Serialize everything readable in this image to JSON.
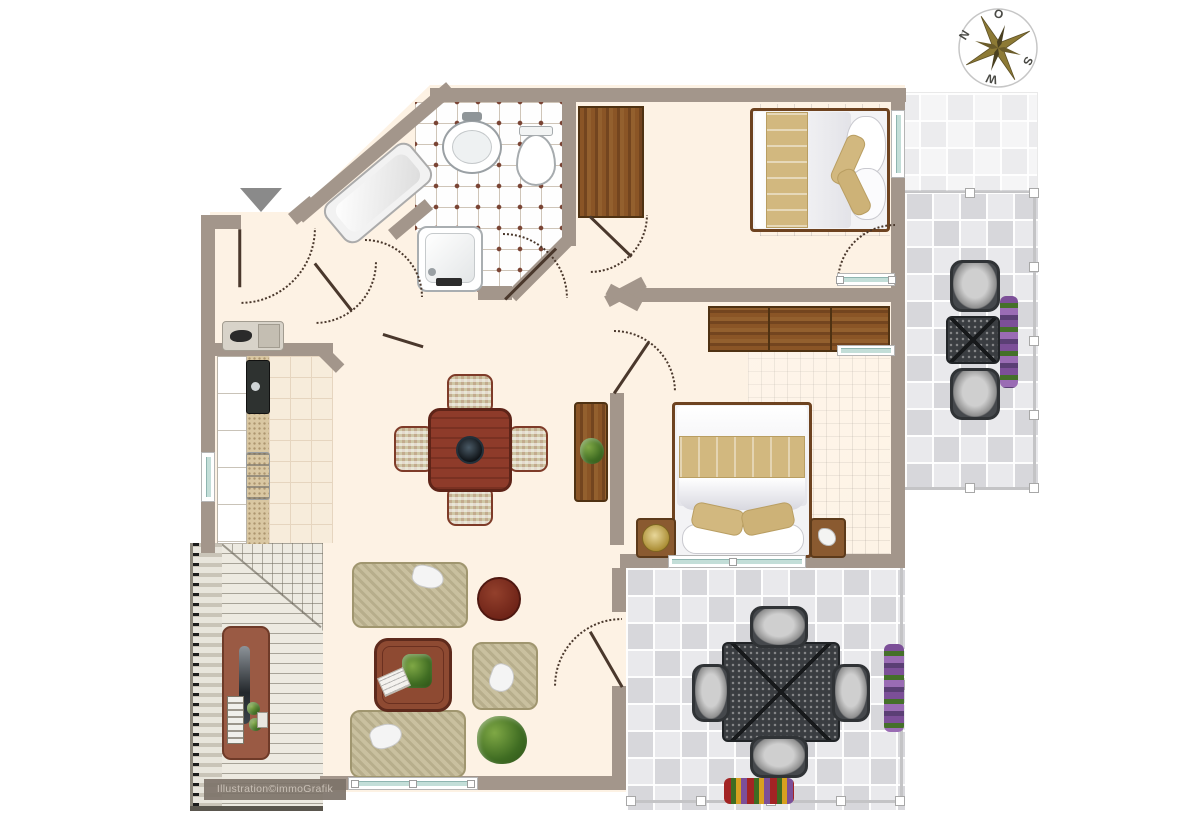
{
  "palette": {
    "wall": "#a3968b",
    "floor": "#fdf2e4",
    "bathdot": "#7a4434",
    "teal": "#c3ded8",
    "door": "#4a382c",
    "wood": "#8a5526",
    "mahogany": "#8e4a32",
    "sofa_beige": "#c9c09f",
    "patio_dark": "#3a3d41",
    "terrace_tile": "#e2e2e5",
    "flower_purple": "#8a5da6",
    "plant_green": "#3f6c22",
    "compass_gold": "#8d7a35"
  },
  "compass": {
    "letter_top": "O",
    "letter_left": "N",
    "letter_right": "S",
    "letter_bottom": "W"
  },
  "watermark": {
    "text": "Illustration©immoGrafik"
  }
}
